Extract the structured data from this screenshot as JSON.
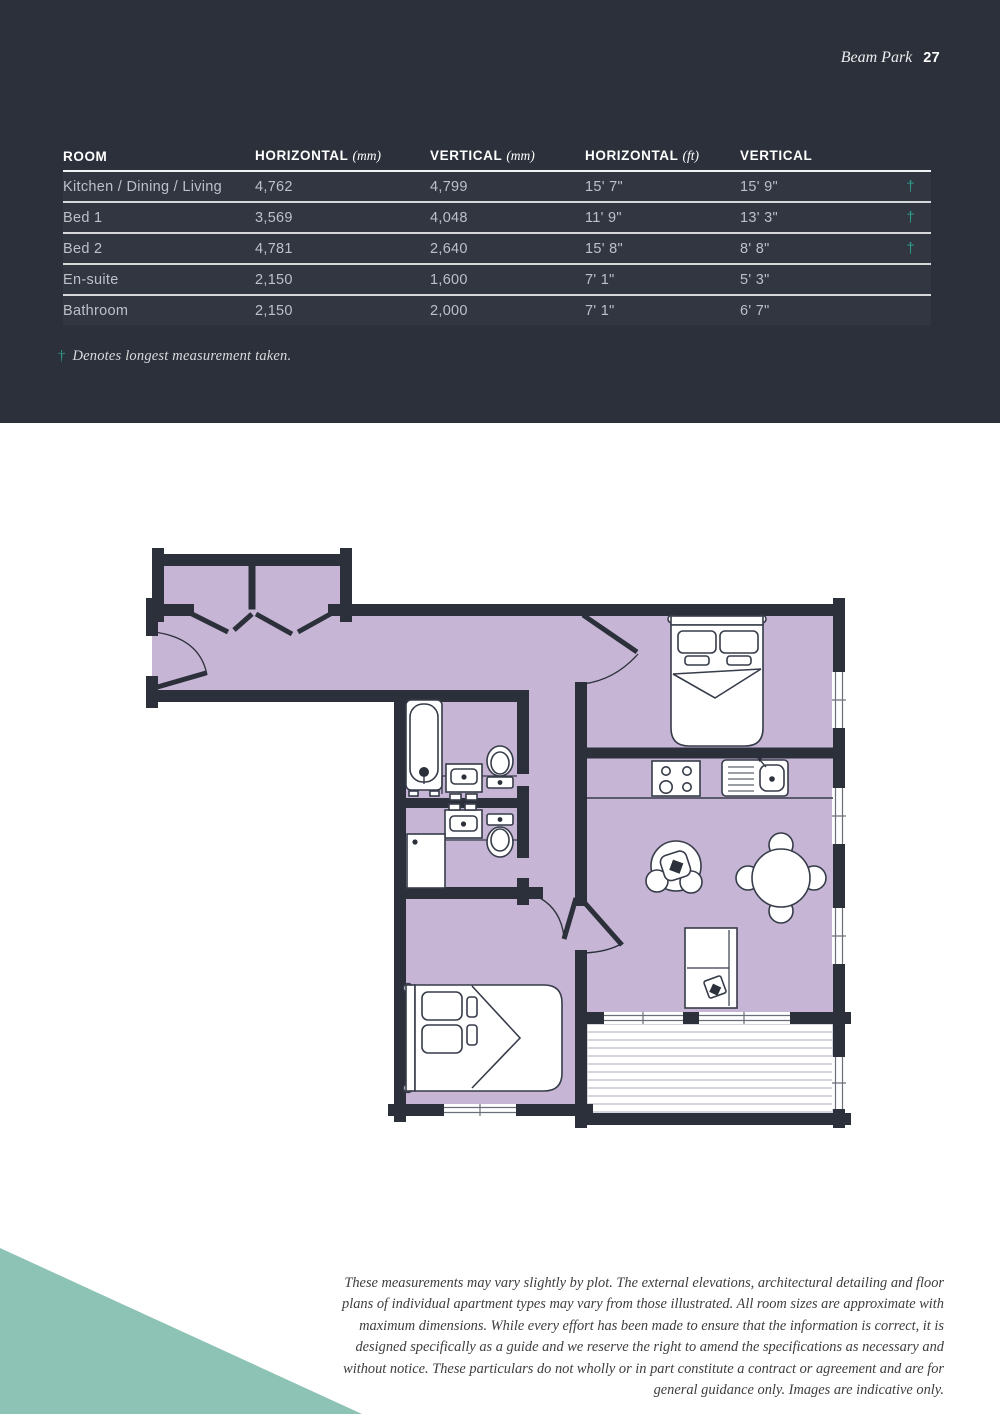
{
  "page": {
    "brand": "Beam Park",
    "page_number": "27"
  },
  "table": {
    "columns": [
      {
        "label": "ROOM",
        "unit": ""
      },
      {
        "label": "HORIZONTAL",
        "unit": "(mm)"
      },
      {
        "label": "VERTICAL",
        "unit": "(mm)"
      },
      {
        "label": "HORIZONTAL",
        "unit": "(ft)"
      },
      {
        "label": "VERTICAL",
        "unit": "(ft)"
      }
    ],
    "rows": [
      {
        "room": "Kitchen / Dining / Living",
        "h_mm": "4,762",
        "v_mm": "4,799",
        "h_ft": "15' 7\"",
        "v_ft": "15' 9\"",
        "dagger": "†"
      },
      {
        "room": "Bed 1",
        "h_mm": "3,569",
        "v_mm": "4,048",
        "h_ft": "11' 9\"",
        "v_ft": "13' 3\"",
        "dagger": "†"
      },
      {
        "room": "Bed 2",
        "h_mm": "4,781",
        "v_mm": "2,640",
        "h_ft": "15' 8\"",
        "v_ft": "8' 8\"",
        "dagger": "†"
      },
      {
        "room": "En-suite",
        "h_mm": "2,150",
        "v_mm": "1,600",
        "h_ft": "7' 1\"",
        "v_ft": "5' 3\"",
        "dagger": ""
      },
      {
        "room": "Bathroom",
        "h_mm": "2,150",
        "v_mm": "2,000",
        "h_ft": "7' 1\"",
        "v_ft": "6' 7\"",
        "dagger": ""
      }
    ],
    "footnote_symbol": "†",
    "footnote": "Denotes longest measurement taken."
  },
  "floorplan": {
    "fixtures": [
      "bath",
      "basin",
      "toilet",
      "shower",
      "double-bed",
      "double-bed",
      "wardrobe-closets",
      "hob",
      "kitchen-sink",
      "armchair",
      "dining-table-with-chairs",
      "sofa",
      "decking"
    ]
  },
  "disclaimer": "These measurements may vary slightly by plot. The external elevations, architectural detailing and floor plans of individual apartment types may vary from those illustrated. All room sizes are approximate with maximum dimensions. While every effort has been made to ensure that the information is correct, it is designed specifically as a guide and we reserve the right to amend the specifications as necessary and without notice. These particulars do not wholly or in part constitute a contract or agreement and are for general guidance only. Images are indicative only.",
  "colors": {
    "header_background": "#2b303a",
    "wall": "#2b303a",
    "accent_teal": "#2f9c8c",
    "corner_triangle_teal": "#8cc3b4",
    "floor_fill": "#c6b5d5"
  }
}
